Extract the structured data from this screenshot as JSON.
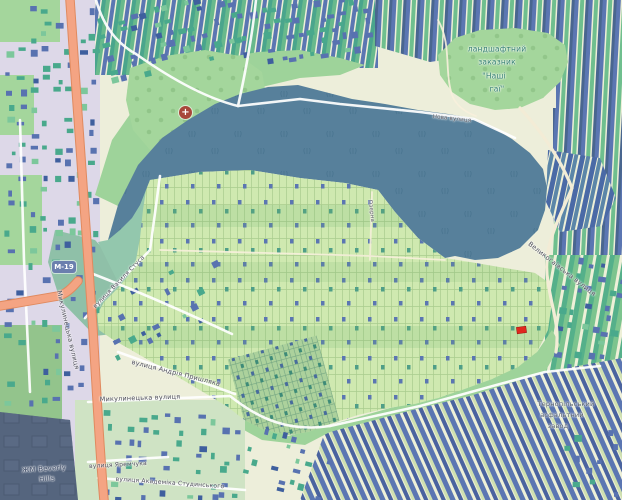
{
  "map": {
    "labels": {
      "road_shield": "М-19",
      "street_mykulynetska_upper": "Микулинецька вулиця",
      "street_mykulynetska_lower": "Микулинецька вулиця",
      "reserve_line1": "ландшафтний",
      "reserve_line2": "заказник",
      "reserve_line3": "\"Наші",
      "reserve_line4": "гаї\"",
      "street_nova": "Нова вулиця",
      "street_vasylia_stusa": "вулиця Василя Стуса",
      "street_andriia_pryshliaka": "вулиця Андрія Пришляка",
      "street_velykohaivska": "Великогаївська вулиця",
      "street_ozerna": "Озерна",
      "district_beverly_line1": "ЖМ Beverly",
      "district_beverly_line2": "Hills",
      "street_yaremchuka": "вулиця Яремчука",
      "street_studynskoho": "вулиця Академіка Студинського",
      "plant_line1": "Тернопільський",
      "plant_line2": "асфальтний",
      "plant_line3": "завод"
    },
    "icons": {
      "hospital": {
        "name": "hospital-icon",
        "glyph": "+"
      }
    },
    "colors": {
      "water": "#57809b",
      "gardens": "#cfe9b0",
      "park_green": "#a4d69c",
      "road_orange": "#f4a483",
      "building_blue": "#5872b0",
      "building_green": "#49a98c",
      "building_navy": "#3e5f9e",
      "building_light": "#7cc79b",
      "urban_base": "#ddd8e8",
      "beverly_area": "#55657e",
      "shield_blue": "#6b7fae",
      "highlight_red": "#e0281e"
    }
  }
}
